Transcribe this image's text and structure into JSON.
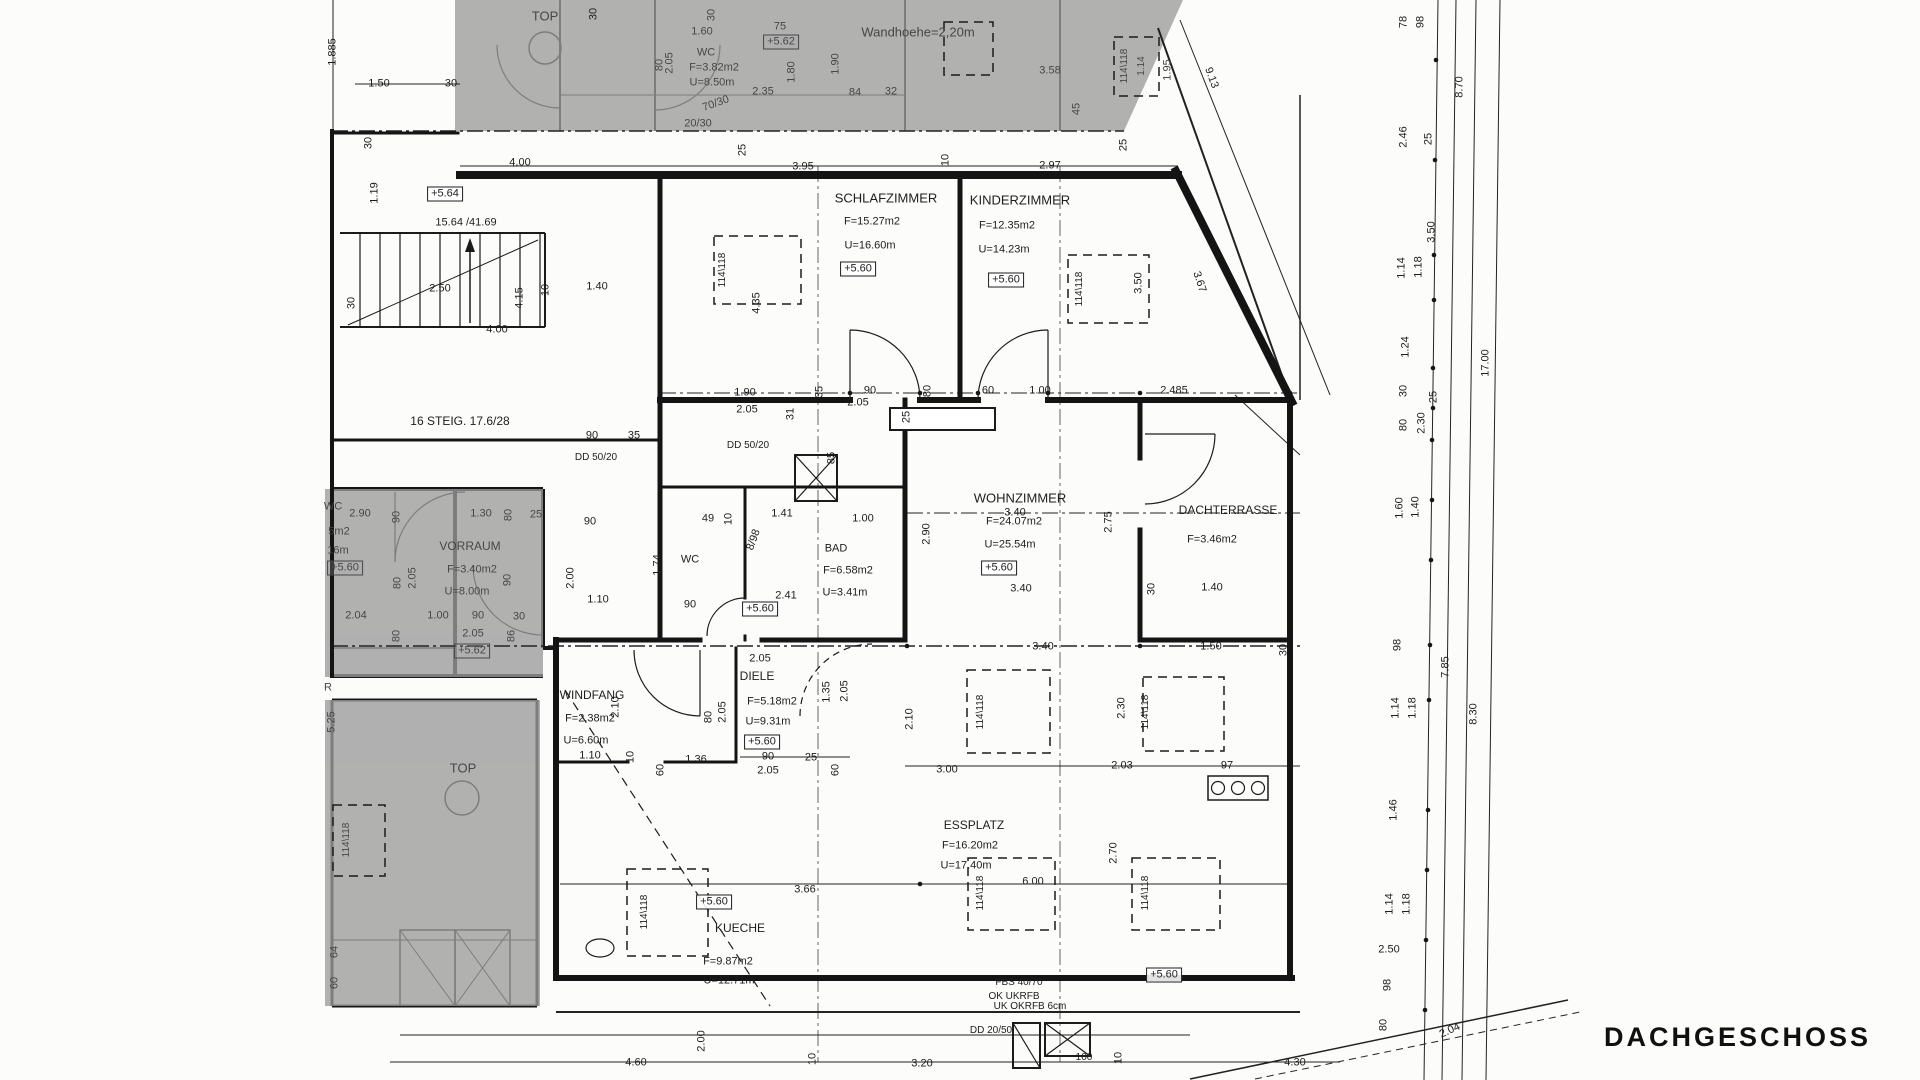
{
  "drawing_title": "DACHGESCHOSS",
  "colors": {
    "line": "#161616",
    "shaded_area": "#9b9b9b",
    "paper": "#fcfcfb"
  },
  "rooms": [
    {
      "name": "SCHLAFZIMMER",
      "area": "F=15.27m2",
      "perimeter": "U=16.60m",
      "level": "+5.60"
    },
    {
      "name": "KINDERZIMMER",
      "area": "F=12.35m2",
      "perimeter": "U=14.23m",
      "level": "+5.60"
    },
    {
      "name": "WOHNZIMMER",
      "area": "F=24.07m2",
      "perimeter": "U=25.54m",
      "level": "+5.60"
    },
    {
      "name": "DACHTERRASSE",
      "area": "F=3.46m2",
      "perimeter": "",
      "level": ""
    },
    {
      "name": "BAD",
      "area": "F=6.58m2",
      "perimeter": "U=3.41m",
      "level": "+5.60"
    },
    {
      "name": "WC",
      "area": "",
      "perimeter": "",
      "level": ""
    },
    {
      "name": "DIELE",
      "area": "F=5.18m2",
      "perimeter": "U=9.31m",
      "level": "+5.60"
    },
    {
      "name": "WINDFANG",
      "area": "F=2.38m2",
      "perimeter": "U=6.60m",
      "level": ""
    },
    {
      "name": "KUECHE",
      "area": "F=9.87m2",
      "perimeter": "U=12.71m",
      "level": "+5.60"
    },
    {
      "name": "ESSPLATZ",
      "area": "F=16.20m2",
      "perimeter": "U=17.40m",
      "level": "+5.60"
    },
    {
      "name": "VORRAUM",
      "area": "F=3.40m2",
      "perimeter": "U=8.00m",
      "level": "+5.60"
    },
    {
      "name": "WC (Nachbartop)",
      "area": "F=3.82m2",
      "perimeter": "U=8.50m",
      "level": "+5.62"
    }
  ],
  "annotations": {
    "wall_height": "Wandhoehe=2,20m",
    "stairs": "16 STEIG. 17.6/28",
    "roof_window": "114\\118",
    "beams": [
      "FBS 40/70",
      "OK UKRFB",
      "UK OKRFB  6cm",
      "DD 20/50",
      "DD 50/20"
    ]
  },
  "labels": [
    {
      "t": "1.885",
      "x": 333,
      "y": 52,
      "r": -90
    },
    {
      "t": "1.50",
      "x": 379,
      "y": 84
    },
    {
      "t": "30",
      "x": 451,
      "y": 84
    },
    {
      "t": "TOP",
      "x": 545,
      "y": 16,
      "s": 13,
      "g": 1
    },
    {
      "t": "30",
      "x": 594,
      "y": 14,
      "r": -90
    },
    {
      "t": "+5.64",
      "x": 445,
      "y": 194,
      "b": 1
    },
    {
      "t": "15.64 /41.69",
      "x": 466,
      "y": 223
    },
    {
      "t": "30",
      "x": 369,
      "y": 143,
      "r": -90
    },
    {
      "t": "1.19",
      "x": 375,
      "y": 193,
      "r": -90
    },
    {
      "t": "2.50",
      "x": 440,
      "y": 289
    },
    {
      "t": "4.15",
      "x": 520,
      "y": 298,
      "r": -90
    },
    {
      "t": "10",
      "x": 546,
      "y": 290,
      "r": -90
    },
    {
      "t": "4.00",
      "x": 497,
      "y": 330
    },
    {
      "t": "1.40",
      "x": 597,
      "y": 287
    },
    {
      "t": "30",
      "x": 352,
      "y": 303,
      "r": -90
    },
    {
      "t": "4.35",
      "x": 757,
      "y": 303,
      "r": -90
    },
    {
      "t": "16 STEIG. 17.6/28",
      "x": 460,
      "y": 421,
      "s": 12
    },
    {
      "t": "90",
      "x": 592,
      "y": 436
    },
    {
      "t": "35",
      "x": 634,
      "y": 436
    },
    {
      "t": "DD 50/20",
      "x": 596,
      "y": 458,
      "s": 10
    },
    {
      "t": "DD 50/20",
      "x": 748,
      "y": 446,
      "s": 10
    },
    {
      "t": "4.00",
      "x": 520,
      "y": 163
    },
    {
      "t": "25",
      "x": 743,
      "y": 150,
      "r": -90
    },
    {
      "t": "3.95",
      "x": 803,
      "y": 167
    },
    {
      "t": "10",
      "x": 946,
      "y": 160,
      "r": -90
    },
    {
      "t": "2.97",
      "x": 1050,
      "y": 166
    },
    {
      "t": "25",
      "x": 1124,
      "y": 145,
      "r": -90
    },
    {
      "t": "1.60",
      "x": 702,
      "y": 32,
      "g": 1
    },
    {
      "t": "30",
      "x": 712,
      "y": 15,
      "r": -90,
      "g": 1
    },
    {
      "t": "WC",
      "x": 706,
      "y": 53,
      "g": 1
    },
    {
      "t": "F=3.82m2",
      "x": 714,
      "y": 68,
      "g": 1
    },
    {
      "t": "U=8.50m",
      "x": 712,
      "y": 83,
      "g": 1
    },
    {
      "t": "75",
      "x": 780,
      "y": 27,
      "g": 1
    },
    {
      "t": "+5.62",
      "x": 781,
      "y": 42,
      "b": 1,
      "g": 1
    },
    {
      "t": "80",
      "x": 660,
      "y": 65,
      "r": -90,
      "g": 1
    },
    {
      "t": "2.05",
      "x": 670,
      "y": 63,
      "r": -90,
      "g": 1
    },
    {
      "t": "1.80",
      "x": 792,
      "y": 72,
      "r": -90,
      "g": 1
    },
    {
      "t": "1.90",
      "x": 836,
      "y": 64,
      "r": -90,
      "g": 1
    },
    {
      "t": "2.35",
      "x": 763,
      "y": 92,
      "g": 1
    },
    {
      "t": "84",
      "x": 855,
      "y": 93,
      "g": 1
    },
    {
      "t": "32",
      "x": 891,
      "y": 92,
      "g": 1
    },
    {
      "t": "Wandhoehe=2,20m",
      "x": 918,
      "y": 32,
      "s": 13,
      "g": 1
    },
    {
      "t": "20/30",
      "x": 698,
      "y": 124,
      "g": 1
    },
    {
      "t": "70/30",
      "x": 716,
      "y": 104,
      "r": -20,
      "g": 1
    },
    {
      "t": "3.58",
      "x": 1050,
      "y": 71,
      "g": 1
    },
    {
      "t": "114\\118",
      "x": 1125,
      "y": 66,
      "r": -90,
      "s": 10,
      "g": 1
    },
    {
      "t": "1.14",
      "x": 1142,
      "y": 66,
      "r": -90,
      "s": 10,
      "g": 1
    },
    {
      "t": "1.95",
      "x": 1168,
      "y": 70,
      "r": -90,
      "g": 1
    },
    {
      "t": "45",
      "x": 1077,
      "y": 109,
      "r": -90,
      "g": 1
    },
    {
      "t": "9.13",
      "x": 1211,
      "y": 78,
      "r": 70
    },
    {
      "t": "78",
      "x": 1404,
      "y": 22,
      "r": -90
    },
    {
      "t": "98",
      "x": 1421,
      "y": 22,
      "r": -90
    },
    {
      "t": "8.70",
      "x": 1460,
      "y": 87,
      "r": -90
    },
    {
      "t": "2.46",
      "x": 1404,
      "y": 137,
      "r": -90
    },
    {
      "t": "25",
      "x": 1429,
      "y": 139,
      "r": -90
    },
    {
      "t": "3.50",
      "x": 1432,
      "y": 232,
      "r": -90
    },
    {
      "t": "1.14",
      "x": 1402,
      "y": 268,
      "r": -90
    },
    {
      "t": "1.18",
      "x": 1419,
      "y": 267,
      "r": -90
    },
    {
      "t": "1.24",
      "x": 1406,
      "y": 347,
      "r": -90
    },
    {
      "t": "17.00",
      "x": 1486,
      "y": 363,
      "r": -90
    },
    {
      "t": "30",
      "x": 1404,
      "y": 391,
      "r": -90
    },
    {
      "t": "25",
      "x": 1434,
      "y": 397,
      "r": -90
    },
    {
      "t": "80",
      "x": 1404,
      "y": 425,
      "r": -90
    },
    {
      "t": "2.30",
      "x": 1422,
      "y": 423,
      "r": -90
    },
    {
      "t": "1.60",
      "x": 1400,
      "y": 508,
      "r": -90
    },
    {
      "t": "1.40",
      "x": 1416,
      "y": 507,
      "r": -90
    },
    {
      "t": "98",
      "x": 1398,
      "y": 645,
      "r": -90
    },
    {
      "t": "7.85",
      "x": 1446,
      "y": 667,
      "r": -90
    },
    {
      "t": "1.14",
      "x": 1396,
      "y": 708,
      "r": -90
    },
    {
      "t": "1.18",
      "x": 1413,
      "y": 708,
      "r": -90
    },
    {
      "t": "8.30",
      "x": 1474,
      "y": 714,
      "r": -90
    },
    {
      "t": "1.46",
      "x": 1394,
      "y": 810,
      "r": -90
    },
    {
      "t": "1.14",
      "x": 1390,
      "y": 904,
      "r": -90
    },
    {
      "t": "1.18",
      "x": 1407,
      "y": 904,
      "r": -90
    },
    {
      "t": "98",
      "x": 1388,
      "y": 985,
      "r": -90
    },
    {
      "t": "80",
      "x": 1384,
      "y": 1025,
      "r": -90
    },
    {
      "t": "SCHLAFZIMMER",
      "x": 886,
      "y": 198,
      "s": 13
    },
    {
      "t": "F=15.27m2",
      "x": 872,
      "y": 222
    },
    {
      "t": "U=16.60m",
      "x": 870,
      "y": 246
    },
    {
      "t": "+5.60",
      "x": 858,
      "y": 269,
      "b": 1
    },
    {
      "t": "114\\118",
      "x": 723,
      "y": 270,
      "r": -90,
      "s": 10
    },
    {
      "t": "KINDERZIMMER",
      "x": 1020,
      "y": 200,
      "s": 13
    },
    {
      "t": "F=12.35m2",
      "x": 1007,
      "y": 226
    },
    {
      "t": "U=14.23m",
      "x": 1004,
      "y": 250
    },
    {
      "t": "+5.60",
      "x": 1006,
      "y": 280,
      "b": 1
    },
    {
      "t": "114\\118",
      "x": 1080,
      "y": 289,
      "r": -90,
      "s": 10
    },
    {
      "t": "3.50",
      "x": 1139,
      "y": 283,
      "r": -90
    },
    {
      "t": "3.67",
      "x": 1199,
      "y": 282,
      "r": 72
    },
    {
      "t": "1.90",
      "x": 745,
      "y": 393
    },
    {
      "t": "2.05",
      "x": 747,
      "y": 410
    },
    {
      "t": "35",
      "x": 820,
      "y": 392,
      "r": -90
    },
    {
      "t": "90",
      "x": 870,
      "y": 391
    },
    {
      "t": "80",
      "x": 928,
      "y": 391,
      "r": -90
    },
    {
      "t": "60",
      "x": 988,
      "y": 391
    },
    {
      "t": "1.00",
      "x": 1040,
      "y": 391
    },
    {
      "t": "2.485",
      "x": 1174,
      "y": 391
    },
    {
      "t": "31",
      "x": 791,
      "y": 414,
      "r": -90
    },
    {
      "t": "2.05",
      "x": 858,
      "y": 403
    },
    {
      "t": "85",
      "x": 832,
      "y": 458,
      "r": -90
    },
    {
      "t": "25",
      "x": 907,
      "y": 417,
      "r": -90
    },
    {
      "t": "WC",
      "x": 690,
      "y": 560
    },
    {
      "t": "BAD",
      "x": 836,
      "y": 549
    },
    {
      "t": "F=6.58m2",
      "x": 848,
      "y": 571
    },
    {
      "t": "U=3.41m",
      "x": 845,
      "y": 593
    },
    {
      "t": "+5.60",
      "x": 760,
      "y": 609,
      "b": 1
    },
    {
      "t": "8/98",
      "x": 754,
      "y": 540,
      "r": -70
    },
    {
      "t": "1.41",
      "x": 782,
      "y": 514
    },
    {
      "t": "1.00",
      "x": 863,
      "y": 519
    },
    {
      "t": "2.41",
      "x": 786,
      "y": 596
    },
    {
      "t": "49",
      "x": 708,
      "y": 519
    },
    {
      "t": "10",
      "x": 729,
      "y": 519,
      "r": -90
    },
    {
      "t": "1.74",
      "x": 658,
      "y": 565,
      "r": -90
    },
    {
      "t": "90",
      "x": 690,
      "y": 605
    },
    {
      "t": "1.10",
      "x": 598,
      "y": 600
    },
    {
      "t": "2.00",
      "x": 571,
      "y": 578,
      "r": -90
    },
    {
      "t": "90",
      "x": 590,
      "y": 522
    },
    {
      "t": "3.40",
      "x": 1015,
      "y": 513
    },
    {
      "t": "WOHNZIMMER",
      "x": 1020,
      "y": 498,
      "s": 13
    },
    {
      "t": "F=24.07m2",
      "x": 1014,
      "y": 522
    },
    {
      "t": "U=25.54m",
      "x": 1010,
      "y": 545
    },
    {
      "t": "+5.60",
      "x": 999,
      "y": 568,
      "b": 1
    },
    {
      "t": "2.75",
      "x": 1109,
      "y": 522,
      "r": -90
    },
    {
      "t": "2.90",
      "x": 927,
      "y": 534,
      "r": -90
    },
    {
      "t": "DACHTERRASSE",
      "x": 1228,
      "y": 510,
      "s": 12
    },
    {
      "t": "F=3.46m2",
      "x": 1212,
      "y": 540
    },
    {
      "t": "1.40",
      "x": 1212,
      "y": 588
    },
    {
      "t": "30",
      "x": 1152,
      "y": 589,
      "r": -90
    },
    {
      "t": "3.40",
      "x": 1021,
      "y": 589
    },
    {
      "t": "3.40",
      "x": 1043,
      "y": 647
    },
    {
      "t": "1.50",
      "x": 1211,
      "y": 647
    },
    {
      "t": "30",
      "x": 1284,
      "y": 650,
      "r": -90
    },
    {
      "t": "2.05",
      "x": 760,
      "y": 659
    },
    {
      "t": "DIELE",
      "x": 757,
      "y": 676,
      "s": 12
    },
    {
      "t": "F=5.18m2",
      "x": 772,
      "y": 702
    },
    {
      "t": "U=9.31m",
      "x": 768,
      "y": 722
    },
    {
      "t": "+5.60",
      "x": 762,
      "y": 742,
      "b": 1
    },
    {
      "t": "90",
      "x": 768,
      "y": 757
    },
    {
      "t": "2.05",
      "x": 768,
      "y": 771
    },
    {
      "t": "1.35",
      "x": 827,
      "y": 692,
      "r": -90
    },
    {
      "t": "2.05",
      "x": 845,
      "y": 691,
      "r": -90
    },
    {
      "t": "25",
      "x": 811,
      "y": 758
    },
    {
      "t": "60",
      "x": 836,
      "y": 770,
      "r": -90
    },
    {
      "t": "WINDFANG",
      "x": 592,
      "y": 695,
      "s": 12
    },
    {
      "t": "F=2.38m2",
      "x": 590,
      "y": 719
    },
    {
      "t": "U=6.60m",
      "x": 586,
      "y": 741
    },
    {
      "t": "1.10",
      "x": 590,
      "y": 756
    },
    {
      "t": "2.10",
      "x": 616,
      "y": 707,
      "r": -90
    },
    {
      "t": "80",
      "x": 709,
      "y": 717,
      "r": -90
    },
    {
      "t": "2.05",
      "x": 723,
      "y": 712,
      "r": -90
    },
    {
      "t": "10",
      "x": 631,
      "y": 757,
      "r": -90
    },
    {
      "t": "60",
      "x": 661,
      "y": 770,
      "r": -90
    },
    {
      "t": "1.36",
      "x": 696,
      "y": 760
    },
    {
      "t": "114\\118",
      "x": 981,
      "y": 712,
      "r": -90,
      "s": 10
    },
    {
      "t": "114\\118",
      "x": 1146,
      "y": 712,
      "r": -90,
      "s": 10
    },
    {
      "t": "2.10",
      "x": 910,
      "y": 719,
      "r": -90
    },
    {
      "t": "2.30",
      "x": 1122,
      "y": 708,
      "r": -90
    },
    {
      "t": "2.03",
      "x": 1122,
      "y": 766
    },
    {
      "t": "97",
      "x": 1227,
      "y": 766
    },
    {
      "t": "3.00",
      "x": 947,
      "y": 770
    },
    {
      "t": "2.70",
      "x": 1114,
      "y": 853,
      "r": -90
    },
    {
      "t": "ESSPLATZ",
      "x": 974,
      "y": 825,
      "s": 12
    },
    {
      "t": "F=16.20m2",
      "x": 970,
      "y": 846
    },
    {
      "t": "U=17.40m",
      "x": 966,
      "y": 866
    },
    {
      "t": "6.00",
      "x": 1033,
      "y": 882
    },
    {
      "t": "114\\118",
      "x": 981,
      "y": 893,
      "r": -90,
      "s": 10
    },
    {
      "t": "114\\118",
      "x": 1146,
      "y": 893,
      "r": -90,
      "s": 10
    },
    {
      "t": "+5.60",
      "x": 1164,
      "y": 975,
      "b": 1
    },
    {
      "t": "+5.60",
      "x": 714,
      "y": 902,
      "b": 1
    },
    {
      "t": "3.66",
      "x": 805,
      "y": 890
    },
    {
      "t": "KUECHE",
      "x": 740,
      "y": 928,
      "s": 12
    },
    {
      "t": "F=9.87m2",
      "x": 728,
      "y": 962
    },
    {
      "t": "U=12.71m",
      "x": 729,
      "y": 981
    },
    {
      "t": "114\\118",
      "x": 645,
      "y": 912,
      "r": -90,
      "s": 10
    },
    {
      "t": "WC",
      "x": 333,
      "y": 507,
      "g": 1
    },
    {
      "t": "2.90",
      "x": 360,
      "y": 514,
      "g": 1
    },
    {
      "t": "5m2",
      "x": 339,
      "y": 532,
      "g": 1
    },
    {
      "t": "16m",
      "x": 338,
      "y": 551,
      "g": 1
    },
    {
      "t": "+5.60",
      "x": 345,
      "y": 568,
      "b": 1,
      "g": 1
    },
    {
      "t": "VORRAUM",
      "x": 470,
      "y": 546,
      "s": 12,
      "g": 1
    },
    {
      "t": "F=3.40m2",
      "x": 472,
      "y": 570,
      "g": 1
    },
    {
      "t": "U=8.00m",
      "x": 467,
      "y": 592,
      "g": 1
    },
    {
      "t": "1.30",
      "x": 481,
      "y": 514,
      "g": 1
    },
    {
      "t": "80",
      "x": 509,
      "y": 515,
      "r": -90,
      "g": 1
    },
    {
      "t": "90",
      "x": 397,
      "y": 517,
      "r": -90,
      "g": 1
    },
    {
      "t": "80",
      "x": 398,
      "y": 583,
      "r": -90,
      "g": 1
    },
    {
      "t": "2.05",
      "x": 413,
      "y": 578,
      "r": -90,
      "g": 1
    },
    {
      "t": "90",
      "x": 508,
      "y": 580,
      "r": -90,
      "g": 1
    },
    {
      "t": "2.04",
      "x": 356,
      "y": 616,
      "g": 1
    },
    {
      "t": "1.00",
      "x": 438,
      "y": 616,
      "g": 1
    },
    {
      "t": "90",
      "x": 478,
      "y": 616,
      "g": 1
    },
    {
      "t": "30",
      "x": 519,
      "y": 617,
      "g": 1
    },
    {
      "t": "80",
      "x": 397,
      "y": 636,
      "r": -90,
      "g": 1
    },
    {
      "t": "2.05",
      "x": 473,
      "y": 634,
      "g": 1
    },
    {
      "t": "+5.62",
      "x": 472,
      "y": 651,
      "b": 1,
      "g": 1
    },
    {
      "t": "86",
      "x": 512,
      "y": 636,
      "r": -90,
      "g": 1
    },
    {
      "t": "25",
      "x": 536,
      "y": 515,
      "g": 1
    },
    {
      "t": "R",
      "x": 328,
      "y": 688,
      "g": 1
    },
    {
      "t": "5.25",
      "x": 332,
      "y": 722,
      "r": -90,
      "g": 1
    },
    {
      "t": "TOP",
      "x": 463,
      "y": 768,
      "s": 13,
      "g": 1
    },
    {
      "t": "114\\118",
      "x": 347,
      "y": 840,
      "r": -90,
      "s": 10,
      "g": 1
    },
    {
      "t": "64",
      "x": 335,
      "y": 952,
      "r": -90,
      "g": 1
    },
    {
      "t": "60",
      "x": 335,
      "y": 983,
      "r": -90,
      "g": 1
    },
    {
      "t": "4.60",
      "x": 636,
      "y": 1063
    },
    {
      "t": "10",
      "x": 813,
      "y": 1059,
      "r": -90
    },
    {
      "t": "3.20",
      "x": 922,
      "y": 1064
    },
    {
      "t": "2.00",
      "x": 702,
      "y": 1041,
      "r": -90
    },
    {
      "t": "FBS 40/70",
      "x": 1019,
      "y": 983,
      "s": 10
    },
    {
      "t": "OK UKRFB",
      "x": 1014,
      "y": 997,
      "s": 10
    },
    {
      "t": "UK OKRFB  6cm",
      "x": 1030,
      "y": 1007,
      "s": 10
    },
    {
      "t": "DD 20/50",
      "x": 991,
      "y": 1031,
      "s": 10
    },
    {
      "t": "100",
      "x": 1084,
      "y": 1058,
      "s": 10
    },
    {
      "t": "10",
      "x": 1119,
      "y": 1058,
      "r": -90
    },
    {
      "t": "4.30",
      "x": 1295,
      "y": 1063
    },
    {
      "t": "2.50",
      "x": 1389,
      "y": 950
    },
    {
      "t": "2.04",
      "x": 1450,
      "y": 1031,
      "r": -25
    }
  ]
}
